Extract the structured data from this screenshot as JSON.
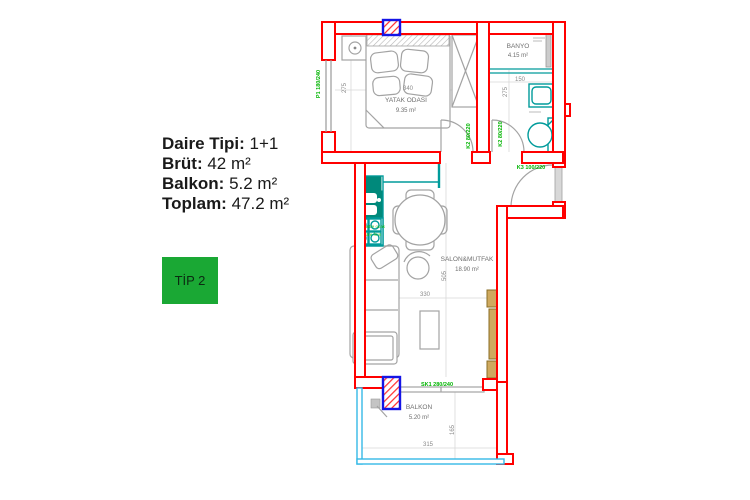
{
  "info_panel": {
    "lines": [
      {
        "label": "Daire Tipi:",
        "value": " 1+1"
      },
      {
        "label": "Brüt:",
        "value": " 42 m²"
      },
      {
        "label": "Balkon:",
        "value": " 5.2 m²"
      },
      {
        "label": "Toplam:",
        "value": " 47.2 m²"
      }
    ],
    "type_badge": "TİP 2"
  },
  "plan": {
    "bedroom": {
      "name": "YATAK ODASI",
      "area": "9.35 m²",
      "width_cm": "340",
      "height_cm": "275"
    },
    "bathroom": {
      "name": "BANYO",
      "area": "4.15 m²",
      "width_cm": "150",
      "height_cm": "275"
    },
    "salon": {
      "name": "SALON&MUTFAK",
      "area": "18.90 m²",
      "width_cm": "330",
      "height_cm": "505"
    },
    "balcony": {
      "name": "BALKON",
      "area": "5.20 m²",
      "width_cm": "315",
      "height_cm": "165"
    },
    "labels": {
      "window": "P1 180/240",
      "bedroom_door": "K2 80/220",
      "bathroom_door": "K2 80/220",
      "entry_door": "K3 100/220",
      "sliding_door": "SK1 280/240",
      "stove_line1": "ankastre ocak",
      "stove_line2": "ankastre fırın"
    },
    "colors": {
      "wall": "#ff0000",
      "fixture_teal": "#009b9b",
      "railing_cyan": "#35b9e6",
      "label_green": "#00b400",
      "column_blue": "#1414e6",
      "badge_green": "#1aa834",
      "wood_tan": "#cfa95e"
    }
  }
}
